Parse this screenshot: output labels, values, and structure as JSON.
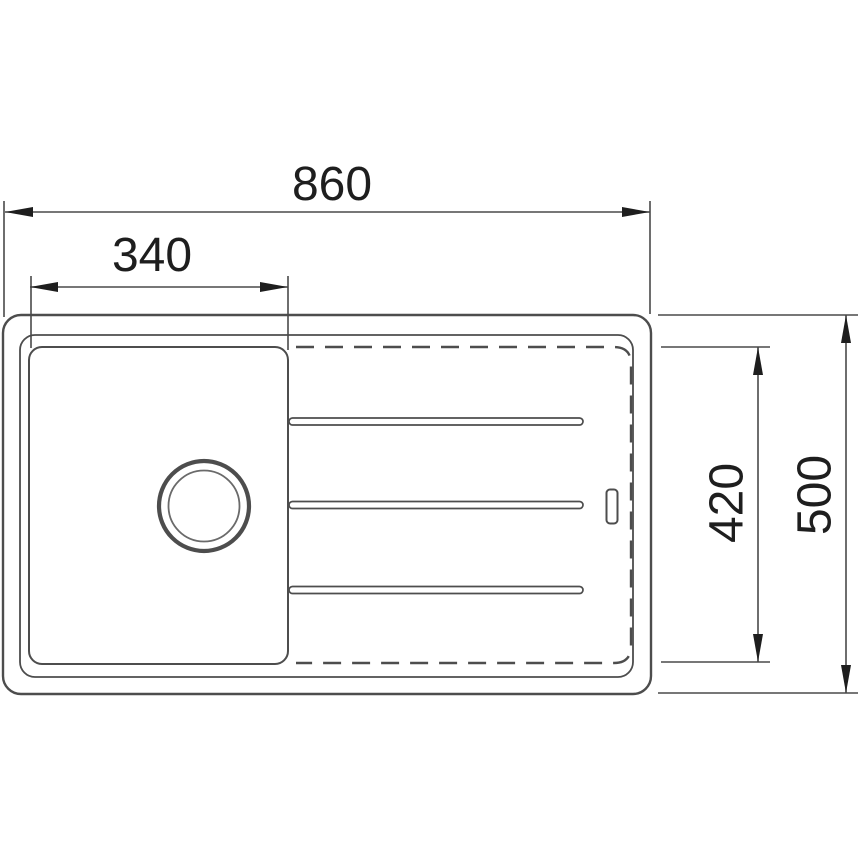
{
  "diagram": {
    "type": "technical-drawing",
    "subject": "kitchen-sink-top-view-with-drainer",
    "colors": {
      "background": "#ffffff",
      "outline": "#4d4d4d",
      "dimension_lines": "#4a4a4a",
      "text": "#1e1e1e"
    },
    "dimensions": {
      "overall_width": "860",
      "bowl_width": "340",
      "drainer_depth": "420",
      "overall_depth": "500"
    }
  }
}
